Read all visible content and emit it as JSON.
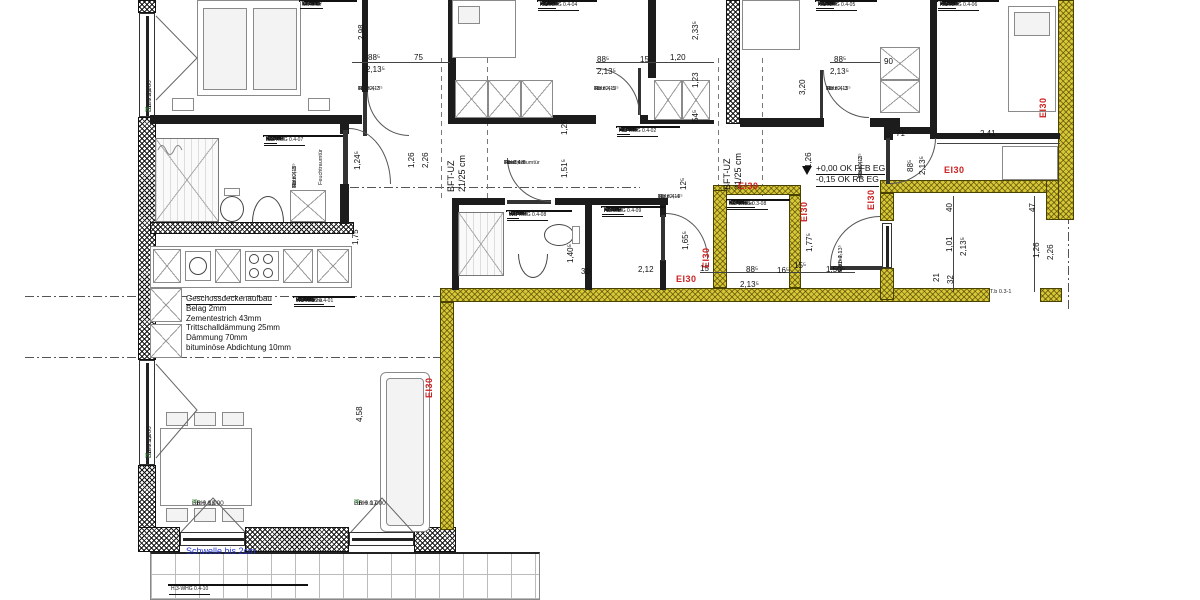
{
  "fire_rating": "EI30",
  "threshold_note": "Schwelle bis 2cm",
  "beam": {
    "line1": "BFT-UZ",
    "line2": "21/25 cm"
  },
  "levels": {
    "ffb": "+0,00 OK FFB EG",
    "rb": "-0,15 OK RB EG"
  },
  "deck_note": {
    "title": "Geschossdeckenaufbau",
    "lines": [
      "Belag 2mm",
      "Zementestrich 43mm",
      "Trittschalldämmung 25mm",
      "Dämmung 70mm",
      "bituminöse Abdichtung 10mm"
    ]
  },
  "field_labels": {
    "area": "Fläche",
    "perimeter": "Umfang",
    "height": "Li. Höhe"
  },
  "colors": {
    "fire_wall": "#d8c838",
    "fire_text": "#cc2222",
    "threshold_text": "#2233cc",
    "window_tag": "#2d8f2d"
  },
  "rooms": [
    {
      "id": "",
      "name": "Schlafen",
      "area": "15,37 m²",
      "perimeter": "17,56 m",
      "height": "2,51 m"
    },
    {
      "id": "H.3-WHG 0.4-07",
      "name": "Bad",
      "area": "5,83 m²",
      "perimeter": "9,85 m",
      "height": "2,39 m"
    },
    {
      "id": "H.3-WHG 0.4-01",
      "name": "Wohnküche",
      "area": "33,02 m²",
      "perimeter": "28,47 m",
      "height": "2,51 m"
    },
    {
      "id": "H.3-WHG 0.4-04",
      "name": "Kind 1",
      "area": "13,40 m²",
      "perimeter": "14,54 m",
      "height": "2,51 m"
    },
    {
      "id": "H.3-WHG 0.4-02",
      "name": "Flur",
      "area": "14,06 m²",
      "perimeter": "23,69 m",
      "height": "2,51 m"
    },
    {
      "id": "H.3-WHG 0.4-08",
      "name": "WC",
      "area": "2,67 m²",
      "perimeter": "6,76 m",
      "height": "2,39 m"
    },
    {
      "id": "H.3-WHG 0.4-09",
      "name": "Abstellr.",
      "area": "3,81 m²",
      "perimeter": "7,88 m",
      "height": "2,51 m"
    },
    {
      "id": "H.3-WHG 0.3-08",
      "name": "Garderobe",
      "area": "1,94 m²",
      "perimeter": "5,64 m",
      "height": "2,51 m"
    },
    {
      "id": "H.3-WHG 0.4-05",
      "name": "Kind 2",
      "area": "10,80 m²",
      "perimeter": "13,11 m",
      "height": "2,51 m"
    },
    {
      "id": "H.3-WHG 0.4-06",
      "name": "Kind 3",
      "area": "10,93 m²",
      "perimeter": "14,68 m",
      "height": "2,51 m"
    },
    {
      "id": "H.3-WHG 0.4-10",
      "name": "",
      "area": "",
      "perimeter": "",
      "height": ""
    }
  ],
  "dimensions": [
    "2,98",
    "88⁵",
    "75",
    "2,13⁵",
    "88⁵",
    "15",
    "1,20",
    "2,13⁵",
    "2,33⁵",
    "1,23",
    "54⁵",
    "88⁵",
    "2,13⁵",
    "90",
    "3,20",
    "71",
    "2,41",
    "88⁵",
    "2,13⁵",
    "1,26",
    "1,51⁵",
    "1,24⁵",
    "1,26",
    "2,26",
    "1,75",
    "1,26",
    "4,58",
    "30",
    "2,12",
    "1,40⁵",
    "1,65⁵",
    "12⁵",
    "15",
    "88⁵",
    "16⁵",
    "2,13⁵",
    "15⁵",
    "1,50⁵",
    "1,77⁵",
    "40",
    "47",
    "1,01",
    "2,13⁵",
    "21",
    "32",
    "1,26",
    "2,26"
  ],
  "doors": [
    {
      "lines": [
        "T.b 0.4-7",
        "88⁵×2,13⁵",
        "Holz"
      ]
    },
    {
      "lines": [
        "T.b 0.4-5",
        "88⁵×2,13⁵",
        "Holz"
      ]
    },
    {
      "lines": [
        "T.b 0.4-3",
        "88⁵×2,13⁵",
        "Holz"
      ]
    },
    {
      "lines": [
        "T.b 0.4-2",
        "88⁵×2,13⁵",
        "Holz"
      ]
    },
    {
      "lines": [
        "T.b 0.4-6",
        "88×2,13⁵",
        "Holz",
        "Feuchtraumtür"
      ]
    },
    {
      "lines": [
        "T.b 0.4-8",
        "88⁵×2,13⁵",
        "Holz"
      ]
    },
    {
      "lines": [
        "Feuchtraumtür"
      ]
    },
    {
      "lines": [
        "T.b 0.4-4",
        "88⁵×2,13⁵",
        "Holz"
      ]
    },
    {
      "lines": [
        "T.b 0.4-1",
        "1,01×2,13⁵",
        "Holz"
      ]
    },
    {
      "lines": [
        "T.b 0.3-1"
      ]
    }
  ],
  "windows": [
    {
      "id": "F.b 0.20",
      "sill": "BRH 0,000",
      "tag": "36"
    },
    {
      "id": "F.b 0.19",
      "sill": "BRH 0,000",
      "tag": "36"
    },
    {
      "id": "F.b 0.18",
      "sill": "BRH 0,000",
      "tag": "36"
    },
    {
      "id": "F.b 0.17",
      "sill": "BRH 0,000",
      "tag": "36"
    }
  ]
}
